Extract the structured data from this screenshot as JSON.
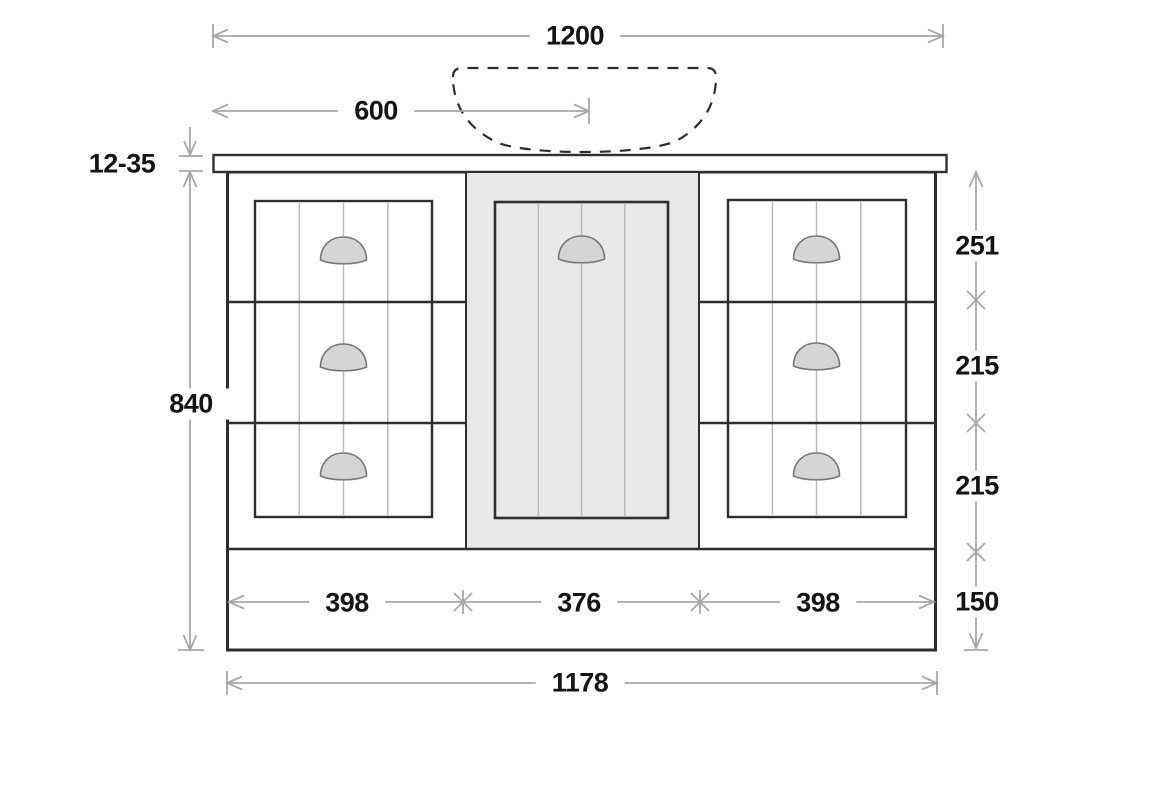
{
  "labels": {
    "overall_width": "1200",
    "sink_center_offset": "600",
    "countertop_thickness": "12-35",
    "cabinet_height": "840",
    "top_drawer_height": "251",
    "middle_drawer_height": "215",
    "bottom_drawer_height": "215",
    "plinth_height": "150",
    "left_section_width": "398",
    "center_section_width": "376",
    "right_section_width": "398",
    "cabinet_width": "1178"
  },
  "colors": {
    "outline": "#2e2e2e",
    "dimension_line": "#a8a8a8",
    "panel_groove": "#b9b9b9",
    "door_fill": "#e8e8e8",
    "handle_fill": "#d5d5d5",
    "handle_stroke": "#787878",
    "label_color": "#141414",
    "background": "#ffffff"
  }
}
